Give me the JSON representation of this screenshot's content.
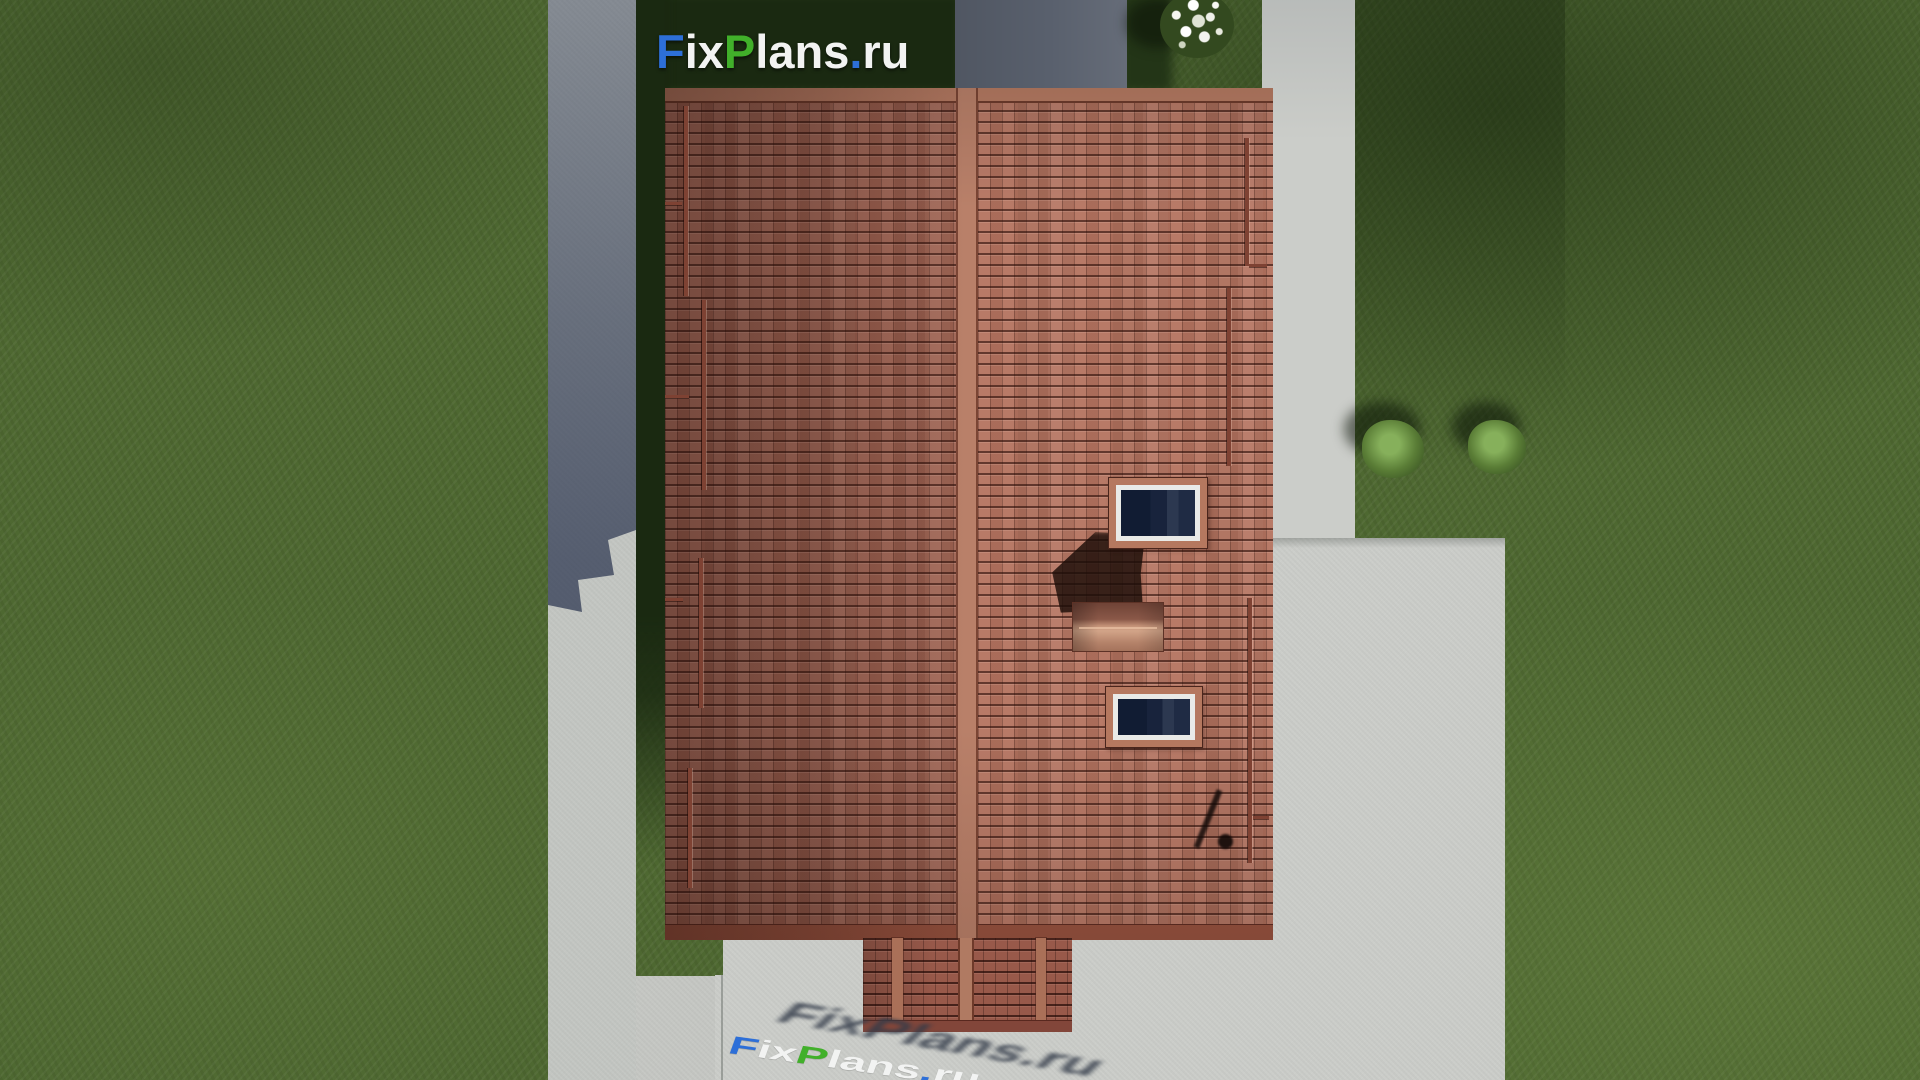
{
  "brand": {
    "name": "FixPlans.ru",
    "segments": [
      {
        "text": "F",
        "color": "#2d6fd8"
      },
      {
        "text": "ix",
        "color": "#f2f3f2"
      },
      {
        "text": "P",
        "color": "#41b02a"
      },
      {
        "text": "lans",
        "color": "#f2f3f2"
      },
      {
        "text": ".",
        "color": "#2d6fd8"
      },
      {
        "text": "ru",
        "color": "#f2f3f2"
      }
    ]
  },
  "scene": {
    "description": "Top-down 3D render of a gable-roof house with terracotta tiles, two roof windows, a chimney, lawn, concrete walkways and patio",
    "skylight_count": 2,
    "bush_count": 3,
    "palette": {
      "grass": "#4e6831",
      "grass_shadow": "#1b2a12",
      "concrete_light": "#cbcdc9",
      "concrete_shadow": "#59606d",
      "roof_tile_lit": "#b4735f",
      "roof_tile_shaded": "#a06352",
      "roof_ridge": "#b98069",
      "roof_eave_band": "#96523f",
      "skylight_glass": "#16213a",
      "skylight_frame": "#e9eae7",
      "chimney_cap": "#c49278"
    }
  }
}
